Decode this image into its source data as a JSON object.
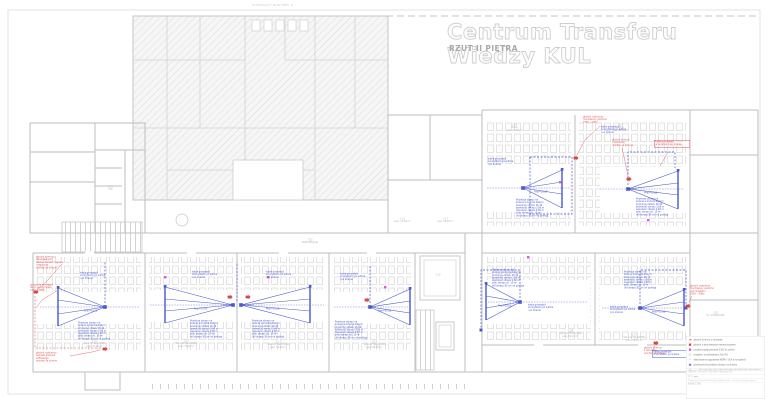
{
  "title": {
    "main": "Centrum Transferu Wiedzy KUL",
    "subtitle": "RZUT II PIĘTRA"
  },
  "plan": {
    "existing_building_label": "ISTNIEJĄCY BUDYNEK A",
    "corridor_label": "2.02\nKOMUNIKACJA",
    "rooms": [
      {
        "label": "2.10\nSALA WYKŁADOWA\npow. 76,40 m²"
      },
      {
        "label": "2.11\nSALA WYKŁADOWA\npow. 74,20 m²"
      },
      {
        "label": "2.12\nSALA WYKŁADOWA\npow. 74,20 m²"
      },
      {
        "label": "2.13\nSALA WYKŁADOWA\npow. 68,90 m²"
      },
      {
        "label": "2.08\nSALA WYKŁADOWA\npow. 82,10 m²"
      },
      {
        "label": "2.07\nSALA WYKŁADOWA\npow. 76,30 m²"
      },
      {
        "label": "2.18\nAULA\npow. 94,60 m²"
      },
      {
        "label": "2.19\nAULA\npow. 98,20 m²"
      }
    ],
    "small_labels": [
      {
        "label": "2.16\npow. 21,40 m²"
      },
      {
        "label": "2.17\npow. 18,60 m²"
      },
      {
        "label": "2.05\nWC"
      },
      {
        "label": "2.15"
      },
      {
        "label": "2.20\nKL. SCHODOWA"
      }
    ]
  },
  "annotations": {
    "projection_note": "Projekcja obrazu na\nścianie w kolorze białym\nproporcje obrazu 16:10\nszerokość obrazu 3,86 m\nwysokość obrazu 2,60 m\npow. obrazu ok. 10 m²\ndół obrazu 80 cm od podłogi",
    "cable_note_long": "kable prowadzić\nw korytkach po suficie\ni po ścianie",
    "cable_note_short": "kable prowadzić\nw korytkach po ścianie",
    "fan_label": "Pow.=10,00",
    "red": [
      {
        "text": "głośnik ścienny z\nwbudowanym\nwzmacniaczem sygnału\ni regulacją\nmontaż na ścianie"
      },
      {
        "text": "przewody zasilające\nukryć pod tynkiem\n230V ~50Hz"
      },
      {
        "text": "głośnik naścienny\nzamiast głośnika\nsufitowego\nmontaż na ścianie"
      },
      {
        "text": "głośnik naścienny\nmontowany poziomo\n230V ~50Hz"
      },
      {
        "text": "głośnik ścienny\nz obudową\nmontaż na ścianie"
      },
      {
        "text": "kable prowadzić\nw korytkach po ścianie"
      },
      {
        "text": "głośnik naścienny\nmontowany poziomo\nnad drzwiami\n230V ~50Hz"
      },
      {
        "text": "głośnik ścienny\nz obudową\nmontaż na ścianie"
      }
    ]
  },
  "legend": {
    "items": [
      {
        "glyph": "◄",
        "color": "#d44444",
        "label": "głośnik ścienny z obudową"
      },
      {
        "glyph": "■",
        "color": "#d44444",
        "label": "głośnik z wbudowanym wzmacniaczem"
      },
      {
        "glyph": "■",
        "color": "#dd55dd",
        "label": "puszka przyłączeniowa 230V w suficie"
      },
      {
        "glyph": "▢",
        "color": "#4a58cc",
        "label": "projektor multimedialny Full HD"
      },
      {
        "glyph": "╌",
        "color": "#4a58cc",
        "label": "okablowanie sygnałowe HDMI / VGA w korytkach"
      },
      {
        "glyph": "▦",
        "color": "#4a58cc",
        "label": "powierzchnia projekcji obrazu na ścianie"
      }
    ]
  },
  "title_block": {
    "object": "OBIEKT:  Centrum Transferu Wiedzy KUL",
    "field_label": "TYT / opis:",
    "description": "Propozycja rozmieszczenia nagłośnienia i urządzeń projekcyjnych",
    "scale": "Skala 1:100"
  },
  "colors": {
    "accent_red": "#e05555",
    "accent_blue": "#4a58cc",
    "magenta": "#dd55dd"
  }
}
